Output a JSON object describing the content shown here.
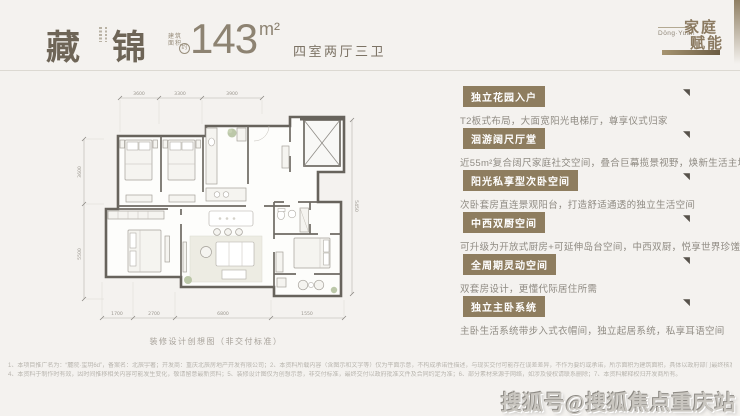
{
  "header": {
    "title_char1": "藏",
    "title_char2": "锦",
    "area_label_line1": "建筑",
    "area_label_line2": "面积",
    "area_approx": "约",
    "area_value": "143",
    "area_unit": "m²",
    "rooms": "四室两厅三卫"
  },
  "logo": {
    "pinyin": "Dōng·Yuán",
    "line1": "家庭",
    "line2": "赋能"
  },
  "floorplan": {
    "caption": "装修设计创想图（非交付标准）",
    "top_dims": [
      "3600",
      "3300",
      "3900"
    ],
    "bottom_dims": [
      "1700",
      "2700",
      "6800",
      "1550"
    ],
    "left_dims": [
      "3600",
      "5500"
    ],
    "right_dims": [
      "5450"
    ]
  },
  "features": [
    {
      "badge": "独立花园入户",
      "desc": "T2板式布局，大面宽阳光电梯厅，尊享仪式归家"
    },
    {
      "badge": "洄游阔尺厅堂",
      "desc": "近55m²复合阔尺家庭社交空间，叠合巨幕揽景视野，焕新生活主场"
    },
    {
      "badge": "阳光私享型次卧空间",
      "desc": "次卧套房直连景观阳台，打造舒适通透的独立生活空间"
    },
    {
      "badge": "中西双厨空间",
      "desc": "可升级为开放式厨房+可延伸岛台空间，中西双厨，悦享世界珍馐"
    },
    {
      "badge": "全周期灵动空间",
      "desc": "双套房设计，更懂代际居住所需"
    },
    {
      "badge": "独立主卧系统",
      "desc": "主卧生活系统带步入式衣帽间，独立起居系统，私享耳语空间"
    }
  ],
  "disclaimer": {
    "line1": "1、本项目推广名为：“麓院·玺玥6d”，备案名：北辰宇著；开发商：重庆北辰房地产开发有限公司；2、本资料所载内容（含图示和文字等）仅为平面示意，不构成承诺性描述，与现实交付可能存在误差差异，不作为要约或承诺，所示面积为建筑面积，具体以政府部门最终核准及双方签订的《商品房买卖合同》约定为准；3、本资料对项目周边环境、交通及其他配套设施的介绍，旨在提供相关信息，不代表开发商对此作出承诺；",
    "line2": "4、本资料于制作时有效，因时间推移相关内容可能发生变化，敬请留意最新资料；5、装修设计图仅为创想示意，非交付标准，最终交付以政府批准文件及合同约定为准；6、部分素材来源于网络，如涉及侵权请联系删除；7、本资料解释权归开发商所有。"
  },
  "watermark": "搜狐号@搜狐焦点重庆站",
  "colors": {
    "page_bg": "#f4f2ef",
    "badge_bg": "#8e7d5f",
    "title_text": "#6e6557",
    "brand_text": "#8b7a61",
    "desc_text": "#8f8b83"
  }
}
